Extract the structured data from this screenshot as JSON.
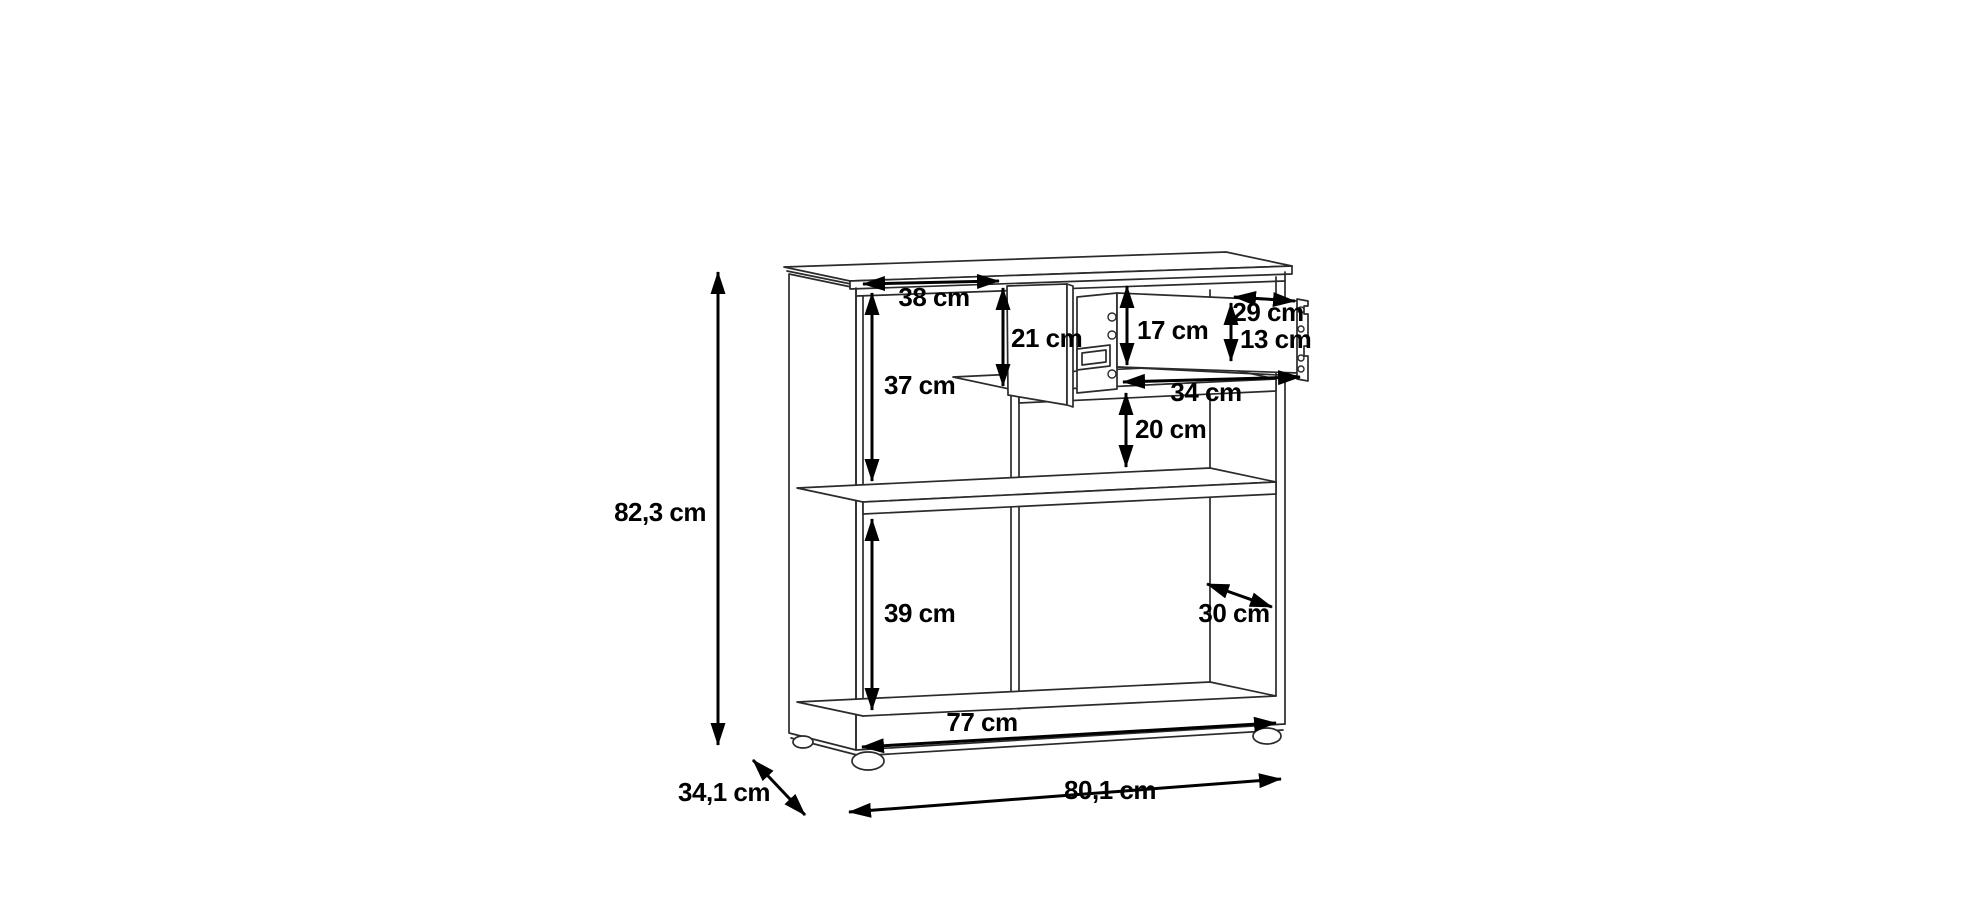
{
  "canvas": {
    "background": "#ffffff",
    "line_color": "#2b2b2b",
    "dimension_color": "#000000"
  },
  "drawing": {
    "title": "sideboard-dimension-diagram",
    "unit": "cm",
    "labels": {
      "overall_height": "82,3 cm",
      "overall_width": "80,1 cm",
      "overall_depth": "34,1 cm",
      "base_width": "77 cm",
      "left_compartment_width": "38 cm",
      "left_compartment_height": "37 cm",
      "door_height": "21 cm",
      "drawer_opening_height": "17 cm",
      "drawer_front_width": "29 cm",
      "drawer_front_height": "13 cm",
      "drawer_depth": "34 cm",
      "gap_below_drawer": "20 cm",
      "lower_compartment_height": "39 cm",
      "interior_depth": "30 cm"
    }
  }
}
